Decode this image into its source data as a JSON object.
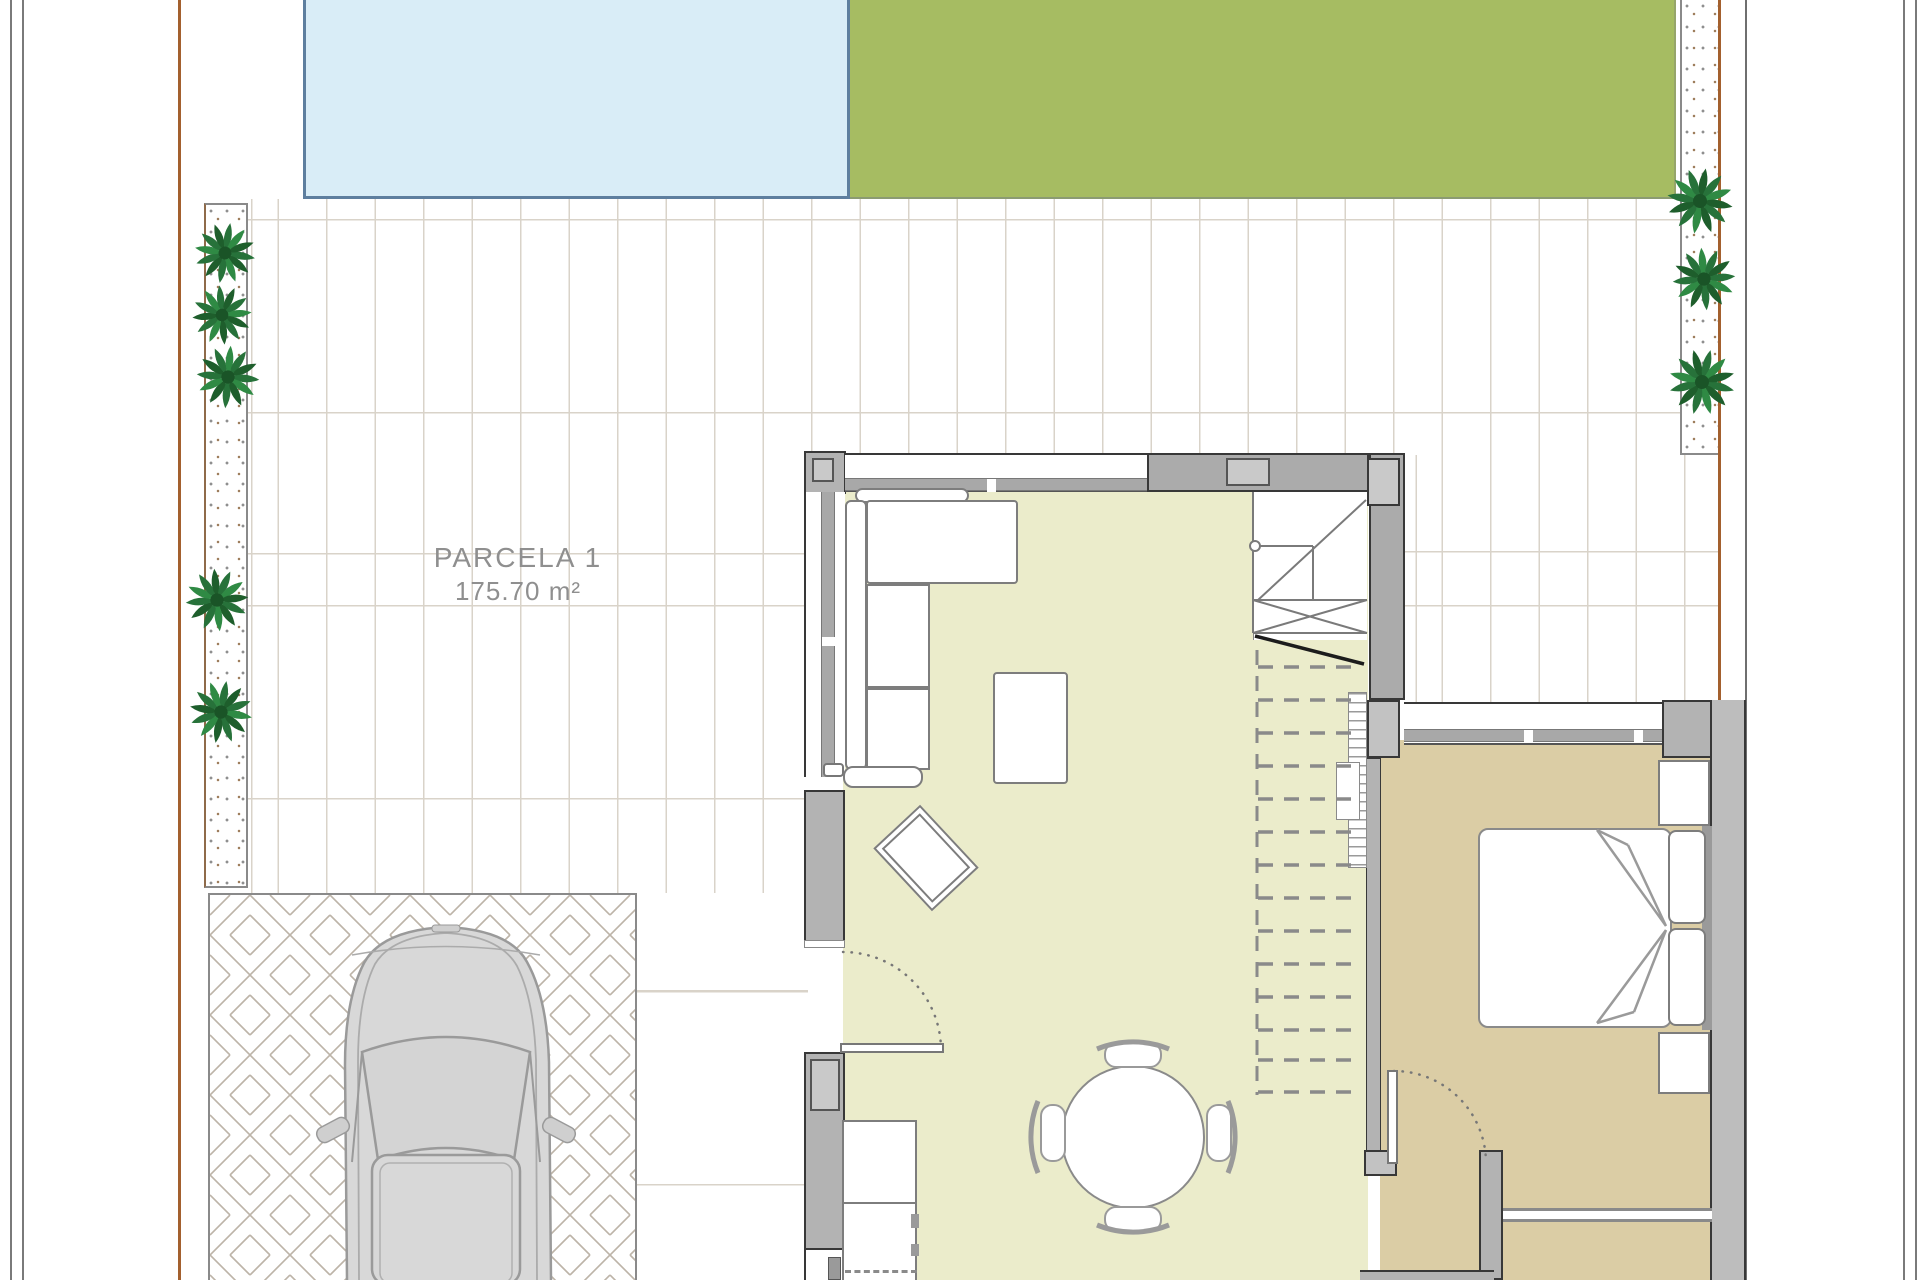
{
  "plan": {
    "parcel_label": "PARCELA 1",
    "parcel_area": "175.70 m²"
  },
  "colors": {
    "pool-fill": "#d9edf7",
    "pool-border": "#5e7f9f",
    "garden-fill": "#a6bc62",
    "living-floor": "#ebeccb",
    "bedroom-floor": "#dbcda5",
    "wall-fill": "#b3b3b3",
    "wall-outline": "#383838",
    "terrace-line": "#d9d3c9",
    "boundary-line": "#a3602e",
    "plant-green": "#27723a",
    "drive-line": "#bdb4a8",
    "car-fill": "#d8d8d8",
    "label-text": "#8f8f8f"
  },
  "icons": {
    "bush": "bush-icon",
    "car": "car-icon",
    "stairs": "stairs-icon",
    "door_swing": "door-swing-icon"
  }
}
